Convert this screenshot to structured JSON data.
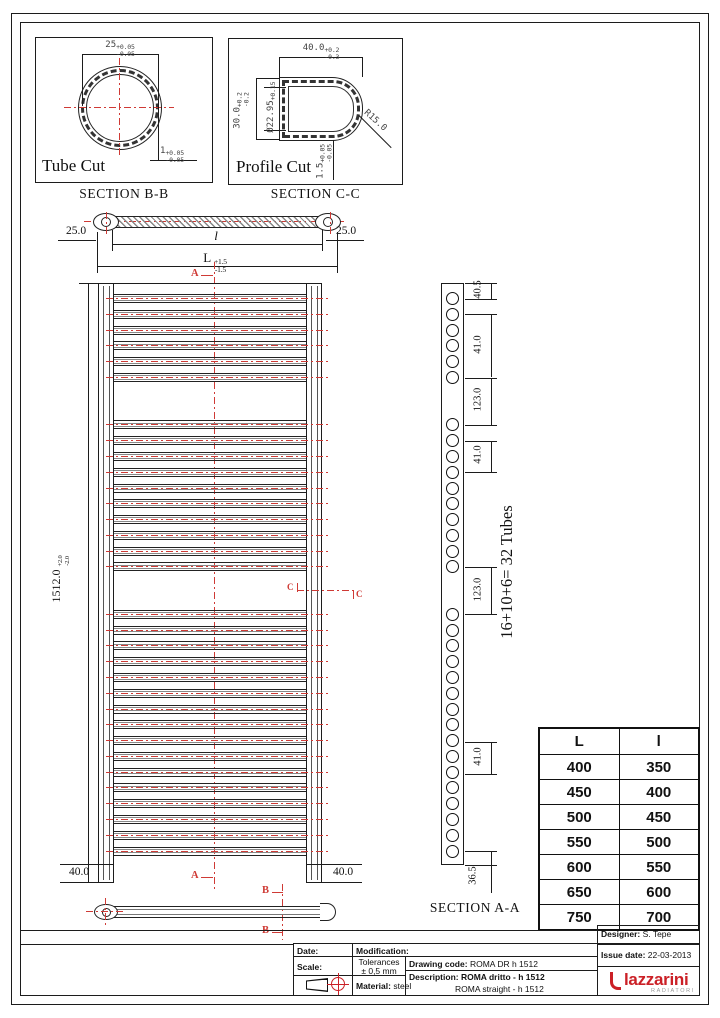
{
  "tube_cut": {
    "title": "Tube Cut",
    "section_label": "SECTION B-B",
    "diameter": {
      "v": "25",
      "p": "+0.05",
      "m": "-0.05"
    },
    "wall": {
      "v": "1",
      "p": "+0.05",
      "m": "-0.05"
    }
  },
  "profile_cut": {
    "title": "Profile Cut",
    "section_label": "SECTION C-C",
    "width": {
      "v": "40.0",
      "p": "+0.2",
      "m": "-0.3"
    },
    "height": {
      "v": "30.0",
      "p": "+0.2",
      "m": "-0.2"
    },
    "bore": {
      "v": "Ø22.95",
      "p": "+0.15",
      "m": ""
    },
    "radius": "R15.0",
    "wall": {
      "v": "1.5",
      "p": "+0.05",
      "m": "-0.05"
    }
  },
  "top_view": {
    "left_offset": "25.0",
    "right_offset": "25.0",
    "inner_length": "l",
    "overall_length": {
      "v": "L",
      "p": "+1.5",
      "m": "-1.5"
    },
    "section_marker_a": "A"
  },
  "front_view": {
    "height": {
      "v": "1512.0",
      "p": "+2.0",
      "m": "-2.0"
    },
    "bottom_left": "40.0",
    "bottom_right": "40.0",
    "marker_a": "A",
    "marker_b": "B",
    "marker_c": "C",
    "tube_groups_top_to_bottom": [
      6,
      10,
      16
    ]
  },
  "side_view": {
    "dimensions": [
      "40.5",
      "41.0",
      "123.0",
      "41.0",
      "123.0",
      "41.0",
      "36.5"
    ],
    "tubes_label": "16+10+6= 32 Tubes",
    "section_label": "SECTION A-A"
  },
  "size_table": {
    "headers": [
      "L",
      "l"
    ],
    "rows": [
      [
        "400",
        "350"
      ],
      [
        "450",
        "400"
      ],
      [
        "500",
        "450"
      ],
      [
        "550",
        "500"
      ],
      [
        "600",
        "550"
      ],
      [
        "650",
        "600"
      ],
      [
        "750",
        "700"
      ]
    ]
  },
  "title_block": {
    "date_label": "Date:",
    "modification_label": "Modification:",
    "scale_label": "Scale:",
    "tolerances_label": "Tolerances",
    "tolerances_value": "± 0,5 mm",
    "material_label": "Material:",
    "material_value": "steel",
    "drawing_code_label": "Drawing code:",
    "drawing_code_value": "ROMA DR h 1512",
    "description_label": "Description:",
    "description_value": "ROMA dritto - h 1512",
    "description_value2": "ROMA straight - h 1512",
    "designer_label": "Designer:",
    "designer_value": "S. Tepe",
    "issue_label": "Issue date:",
    "issue_value": "22-03-2013",
    "brand": "lazzarini",
    "brand_sub": "RADIATORI"
  },
  "colors": {
    "line": "#1c1c1c",
    "dimension_red": "#cf3a35",
    "brand_red": "#cb2026"
  }
}
